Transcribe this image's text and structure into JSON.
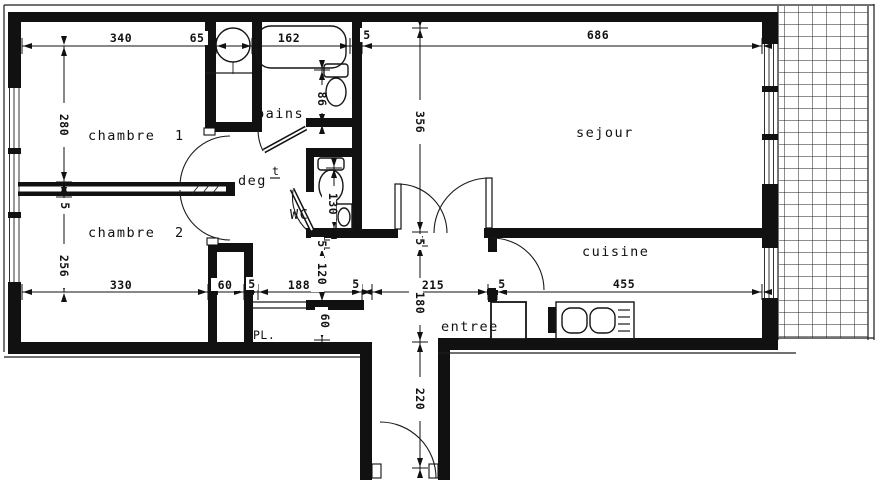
{
  "title": "apartment floor plan (scanned blueprint)",
  "rooms": {
    "chambre1": "chambre 1",
    "chambre2": "chambre 2",
    "bains": "bains",
    "wc": "WC",
    "deg": "deg",
    "deg_sup": "t",
    "sejour": "sejour",
    "cuisine": "cuisine",
    "entree": "entree",
    "placard": "PL."
  },
  "dims": {
    "t340": "340",
    "t65": "65",
    "t162": "162",
    "t5": "5",
    "t686": "686",
    "l280": "280",
    "l5": "5",
    "l256": "256",
    "c86": "86",
    "c130": "130",
    "c5": "5",
    "c120": "120",
    "c60": "60",
    "r356": "356",
    "r5": "5",
    "r180": "180",
    "r220": "220",
    "b330": "330",
    "b60": "60",
    "b5a": "5",
    "b188": "188",
    "b5b": "5",
    "b215": "215",
    "b5c": "5",
    "b455": "455"
  },
  "colors": {
    "wall": "#111111",
    "line": "#1c1c1c",
    "paper": "#ffffff"
  }
}
